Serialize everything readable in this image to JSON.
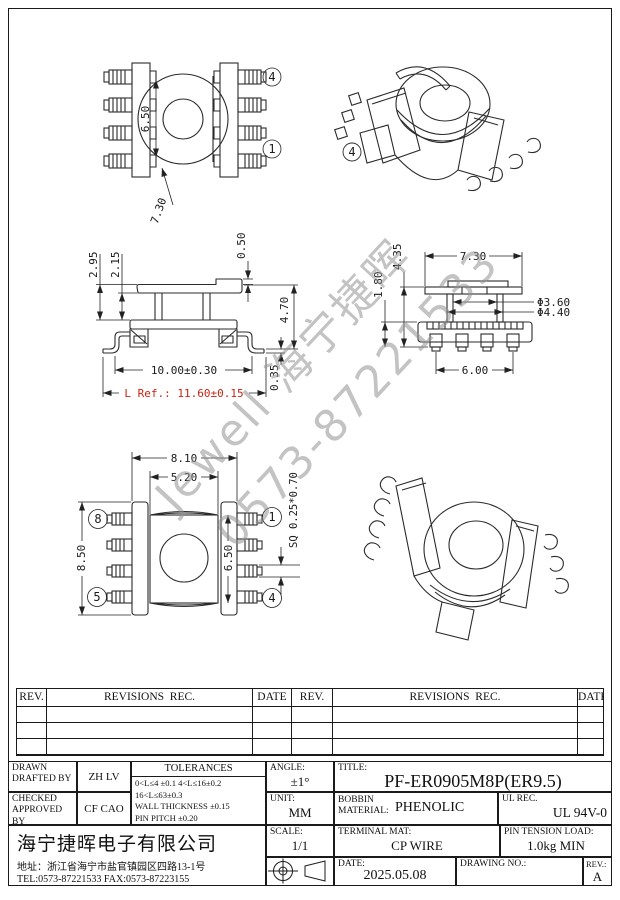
{
  "watermark": {
    "line1": "Jewell 海宁捷晖",
    "line2": "0573-87221533"
  },
  "views": {
    "top": {
      "bore_dia": "6.50",
      "outer_dia": "7.30",
      "pin_top": "4",
      "pin_bottom": "1"
    },
    "iso_top": {
      "pin_label": "4"
    },
    "front": {
      "flange_h": "2.95",
      "inner_h": "2.15",
      "step": "0.50",
      "total_h": "4.70",
      "foot_t": "0.35",
      "width": "10.00±0.30",
      "l_ref": "L Ref.: 11.60±0.15"
    },
    "side": {
      "total_h": "4.35",
      "base_h": "1.80",
      "flange_w": "7.30",
      "tube_id": "Φ3.60",
      "tube_od": "Φ4.40",
      "pad_span": "6.00"
    },
    "bottom": {
      "flange_w": "8.10",
      "body_w": "5.20",
      "length": "8.50",
      "window_h": "6.50",
      "pin_sq": "SQ 0.25*0.70",
      "pin_tl": "8",
      "pin_bl": "5",
      "pin_tr": "1",
      "pin_br": "4"
    }
  },
  "revision_table": {
    "headers": [
      "REV.",
      "REVISIONS  REC.",
      "DATE",
      "REV.",
      "REVISIONS  REC.",
      "DATE"
    ]
  },
  "title_block": {
    "drawn_line1": "DRAWN",
    "drawn_line2": "DRAFTED BY",
    "drawn_value": "ZH LV",
    "checked_line1": "CHECKED",
    "checked_line2": "APPROVED BY",
    "checked_value": "CF CAO",
    "tolerances_title": "TOLERANCES",
    "tol_line1": "0<L≤4 ±0.1 4<L≤16±0.2",
    "tol_line2": "16<L≤63±0.3",
    "tol_line3": "WALL THICKNESS ±0.15",
    "tol_line4": "PIN PITCH ±0.20",
    "angle_label": "ANGLE:",
    "angle_value": "±1°",
    "unit_label": "UNIT:",
    "unit_value": "MM",
    "scale_label": "SCALE:",
    "scale_value": "1/1",
    "title_label": "TITLE:",
    "title_value": "PF-ER0905M8P(ER9.5)",
    "bobbin_label1": "BOBBIN",
    "bobbin_label2": "MATERIAL:",
    "bobbin_value": "PHENOLIC",
    "ul_label": "UL REC.",
    "ul_value": "UL 94V-0",
    "terminal_label": "TERMINAL MAT:",
    "terminal_value": "CP WIRE",
    "tension_label": "PIN TENSION LOAD:",
    "tension_value": "1.0kg MIN",
    "date_label": "DATE:",
    "date_value": "2025.05.08",
    "drawing_no_label": "DRAWING NO.:",
    "rev_label": "REV.:",
    "rev_value": "A",
    "company": "海宁捷晖电子有限公司",
    "address": "地址：浙江省海宁市盐官镇园区四路13-1号",
    "contact": "TEL:0573-87221533 FAX:0573-87223155"
  }
}
